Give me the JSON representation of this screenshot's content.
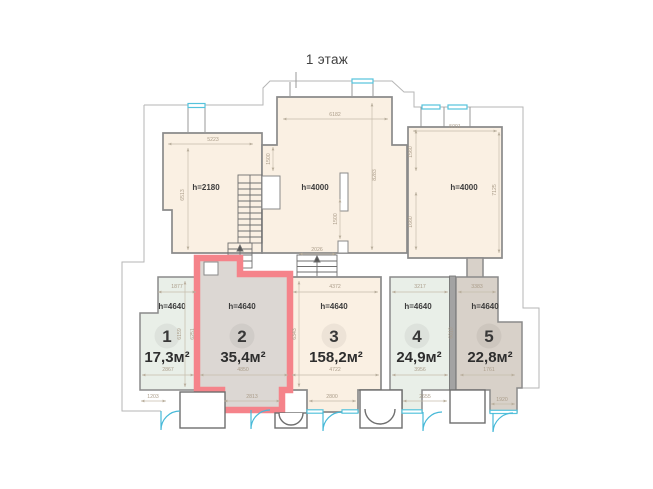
{
  "title": "1 этаж",
  "colors": {
    "highlight_red": "#f5838a",
    "window_blue": "#55c3dc",
    "room_beige": "#faf0e3",
    "room_green": "#e9efe8",
    "room_grey": "#dcd7d3",
    "room_taupe": "#d8d1c9",
    "wall_grey": "#8a8a8a",
    "dim_text": "#ab9d8a"
  },
  "rooms": [
    {
      "height": "h=2180"
    },
    {
      "height": "h=4000"
    },
    {
      "height": "h=4000"
    }
  ],
  "units": [
    {
      "number": "1",
      "area": "17,3м²",
      "height": "h=4640",
      "highlighted": false
    },
    {
      "number": "2",
      "area": "35,4м²",
      "height": "h=4640",
      "highlighted": true
    },
    {
      "number": "3",
      "area": "158,2м²",
      "height": "h=4640",
      "highlighted": false
    },
    {
      "number": "4",
      "area": "24,9м²",
      "height": "h=4640",
      "highlighted": false
    },
    {
      "number": "5",
      "area": "22,8м²",
      "height": "h=4640",
      "highlighted": false
    }
  ],
  "dims": {
    "tl": "5223",
    "tc": "6182",
    "tr": "5091",
    "lv": "6513",
    "clv": "1500",
    "sv": "1500",
    "crv": "8283",
    "rv1": "1560",
    "rv2": "1660",
    "rrv": "7125",
    "sw": "2026",
    "u1t": "1877",
    "u1b": "2867",
    "u1d": "1203",
    "u1v": "6159",
    "u2v": "6251",
    "u2b": "4850",
    "u2d": "2813",
    "u3t": "4372",
    "u3b": "4722",
    "u3d": "2800",
    "u3v": "6343",
    "u4t": "3217",
    "u4b": "3956",
    "u4d": "2655",
    "wv": "6010",
    "u5t": "3383",
    "u5b": "1761",
    "u5d": "1920"
  }
}
